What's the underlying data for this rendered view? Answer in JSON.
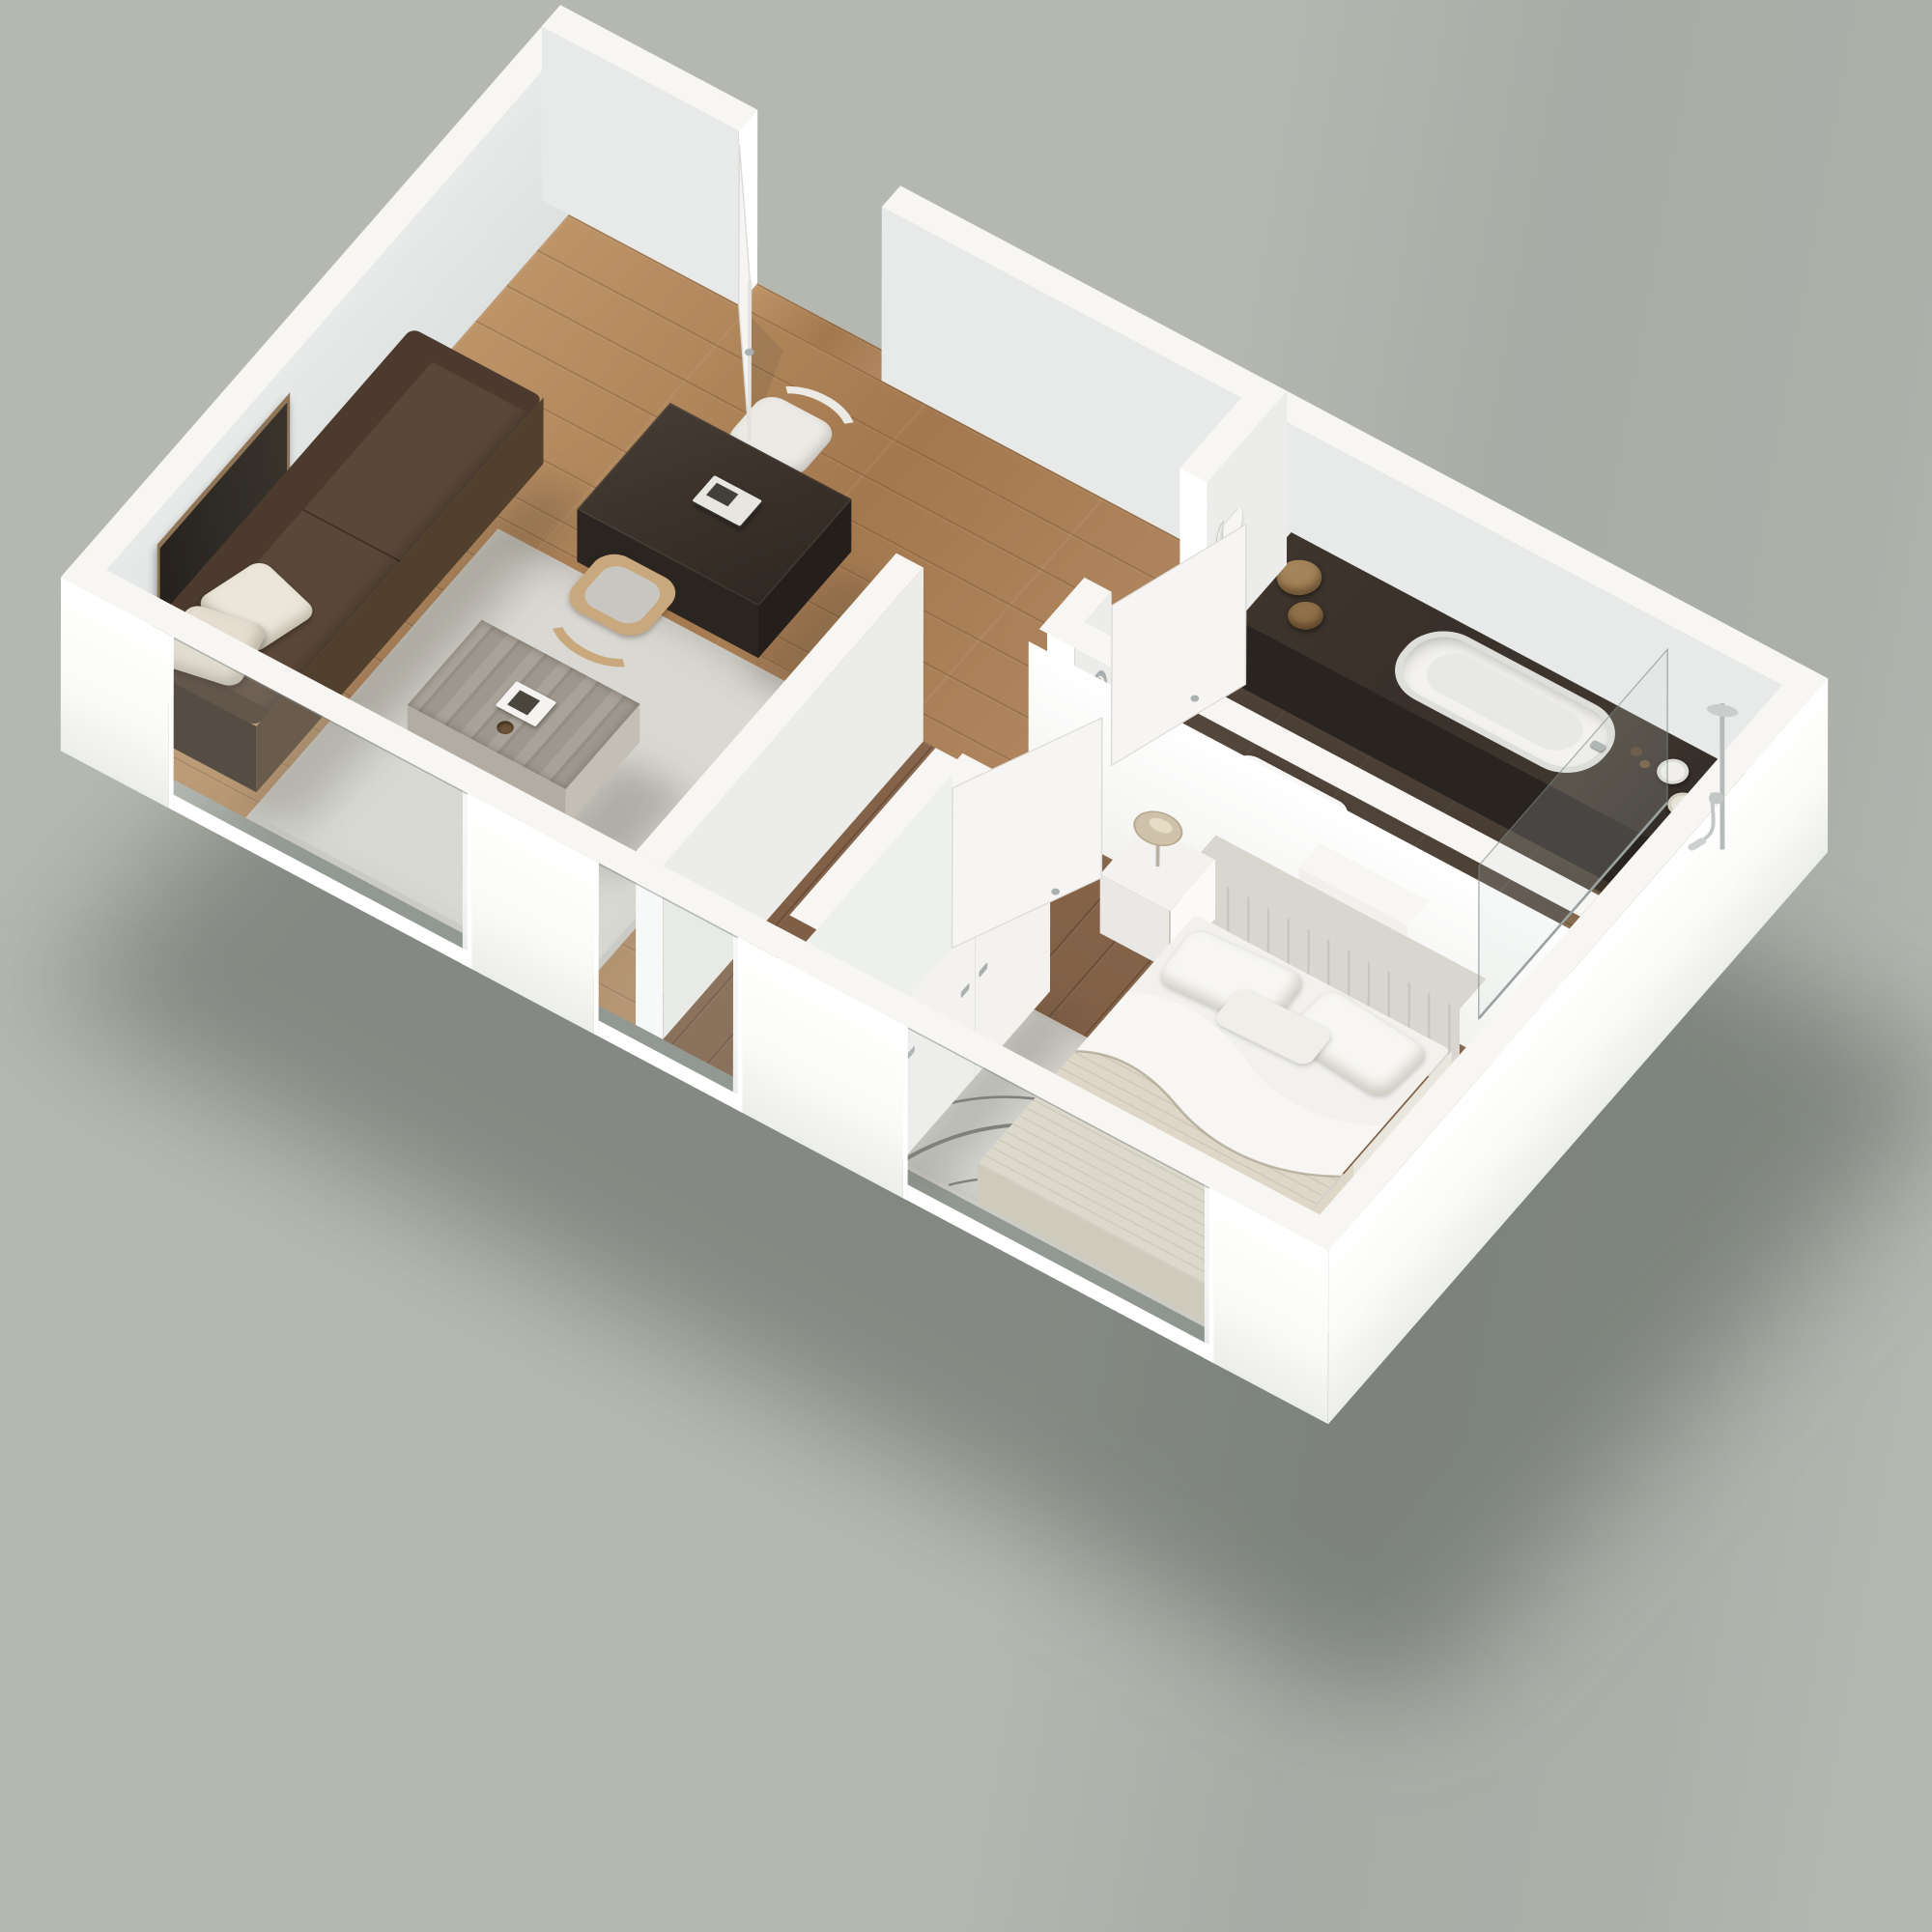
{
  "scene": {
    "type": "isometric-3d-floor-plan-render",
    "background": "#b5b8b1",
    "ground_shadow": "rgba(64,74,66,0.42)",
    "rooms": [
      {
        "name": "living-room",
        "floor": "oak-light"
      },
      {
        "name": "entry-foyer",
        "floor": "oak-light"
      },
      {
        "name": "hallway",
        "floor": "walnut-dark"
      },
      {
        "name": "bathroom",
        "floor": "dark-tile"
      },
      {
        "name": "bedroom",
        "floor": "walnut-dark"
      }
    ],
    "objects": [
      "sofa",
      "sofa-pillows",
      "wall-art",
      "dining-table",
      "books",
      "chair-white",
      "chair-wood",
      "living-rug",
      "coffee-table",
      "magazine",
      "entry-door",
      "bathroom-door",
      "bedroom-door",
      "bathroom-counter",
      "bathtub",
      "baskets",
      "rolled-towels",
      "toiletry-bottles",
      "sink",
      "faucet",
      "toilet",
      "cistern-ledge",
      "flush-plate",
      "toilet-paper-roll",
      "towel-ring",
      "hand-towel",
      "hairdryer",
      "shower-glass",
      "shower-set",
      "shower-tray",
      "wardrobe",
      "bed",
      "headboard",
      "bed-pillows",
      "duvet",
      "blanket",
      "nightstand",
      "table-lamp",
      "bedroom-rug",
      "window-living",
      "window-hall",
      "window-bedroom"
    ]
  },
  "palette": {
    "bg": "#b5b8b1",
    "groundShadow": "rgba(64,74,66,0.42)",
    "wallTop": "#f7f6f3",
    "wallBright": "#ffffff",
    "wallExt": "#fafaf7",
    "wallExtShade": "#eceeea",
    "wallIn": "#e7eae8",
    "wallInDeep": "#dde1e0",
    "floorLivingLight": "#bd9468",
    "floorLiving": "#b08760",
    "floorLivingDark": "#a3784e",
    "floorDark": "#7a5a40",
    "floorDarkHi": "#85644a",
    "floorBath": "#4e4238",
    "showerFloor": "#8b6e51",
    "showerDark": "#44382d",
    "counterTop": "#38302a",
    "counterFace": "#2a2421",
    "counterSide": "#241f1c",
    "rugLiving": "#d9d8d2",
    "rugEdge": "#c8c7c0",
    "rugBed": "#d4d3cd",
    "rugPattern": "#6e6d67",
    "sofa": "#4b3a2d",
    "sofaSeat": "#5a4739",
    "sofaDark": "#3a2d23",
    "sofaSide": "#52402f",
    "pillow": "#ece6da",
    "tableTop": "#3b322b",
    "tableFace": "#2b2521",
    "tableSide": "#241f1b",
    "chairWhite": "#eceae5",
    "chairWood": "#c9a87d",
    "cushion": "#c7c6c1",
    "coffeeTop": "#9d978d",
    "coffeeFace": "#b2aca2",
    "coffeeLeg": "#e9e9e7",
    "bedWhite": "#f2f1ed",
    "blanket": "#ded7c8",
    "blanketEdge": "#cfc7b6",
    "headboard": "#d9d6d0",
    "headboardDark": "#c9c6c0",
    "pillowBed": "#f7f6f2",
    "nightstand": "#f3f2f0",
    "lamp": "#cfc2aa",
    "wardrobe": "#f3f2ef",
    "wardrobeShade": "#e9ebe7",
    "chrome": "#a9b0af",
    "door": "#f6f5f3",
    "doorEdge": "#dddbd7",
    "art": "#2e2a25",
    "artFrame": "#8f7556",
    "tub": "#f3f2ef",
    "tubInner": "#e8e8e5",
    "sink": "#f7f7f5",
    "sinkInner": "#e6e7e5",
    "toilet": "#f5f4f2",
    "towel": "#c8b295",
    "towelWhite": "#f0efec",
    "potA": "#a5845a",
    "potB": "#8f7049",
    "bottle": "#5a432d",
    "glass": "rgba(210,220,218,0.18)",
    "glassEdge": "rgba(125,136,133,0.6)"
  }
}
